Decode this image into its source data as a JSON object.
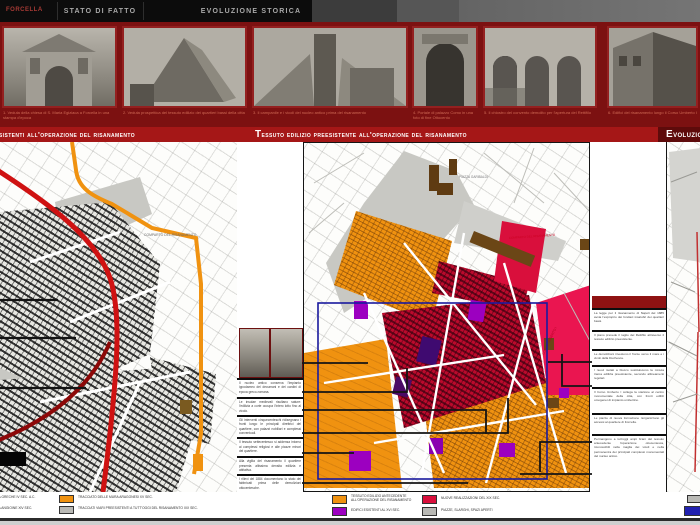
{
  "poster": {
    "region_label": "FORCELLA"
  },
  "tabs": [
    {
      "label": "STATO DI FATTO"
    },
    {
      "label": "EVOLUZIONE STORICA"
    }
  ],
  "titles": {
    "left": "Tracciati preesistenti all'operazione del risanamento",
    "center": "Tessuto edilizio preesistente all'operazione del risanamento",
    "right": "Evoluzione storica"
  },
  "photo_strip": {
    "photos": [
      {
        "caption": "1. Veduta della chiesa di S. Maria Egiziaca a Forcella in una stampa d'epoca"
      },
      {
        "caption": "2. Veduta prospettica del tessuto edilizio dei quartieri bassi della citta"
      },
      {
        "caption": "3. Il campanile e i vicoli del nucleo antico prima del risanamento"
      },
      {
        "caption": "4. Portale di palazzo Como in una foto di fine Ottocento"
      },
      {
        "caption": "5. Il chiostro del convento demolito per l'apertura del Rettifilo"
      },
      {
        "caption": "6. Edifici del risanamento lungo il Corso Umberto I"
      }
    ]
  },
  "left_map": {
    "label_comparto": "COMPARTO DEL RISANAMENTO"
  },
  "center_map": {
    "label_piazza": "PIAZZA GARIBALDI",
    "label_comparto": "COMPARTO DEL RISANAMENTO",
    "label_corso": "CORSO UMBERTO I"
  },
  "mid_notes": [
    "Il nucleo antico conserva l'impianto ippodameo dei decumani e dei cardini di epoca greco-romana.",
    "Le insulae medievali risultano sature: l'edilizia a corte occupa l'intero lotto fino al vicolo.",
    "Gli interventi cinquecenteschi ridisegnano i fronti lungo le principali direttrici del quartiere, con palazzi nobiliari e complessi conventuali.",
    "Il tessuto settecentesco si addensa intorno ai complessi religiosi e alle piazze minori del quartiere.",
    "Alla vigilia del risanamento il quartiere presenta altissima densita edilizia e abitativa.",
    "I rilievi del 1884 documentano lo stato dei fabbricati prima delle demolizioni ottocentesche."
  ],
  "right_notes": [
    "La legge per il risanamento di Napoli del 1885 avvia l'esproprio dei fondaci insalubri dei quartieri bassi.",
    "Il piano prevede il taglio del Rettifilo attraverso il tessuto edilizio preesistente.",
    "Le demolizioni investono il fronte verso il mare e i vicoli della Duchesca.",
    "I nuovi isolati a blocco sostituiscono la minuta trama edilizia preesistente, secondo allineamenti regolari.",
    "Il Corso Umberto I collega la stazione al centro monumentale della citta, con fronti edilizi omogenei di impianto umbertino.",
    "Le piazze di nuova formazione riorganizzano gli accessi al quartiere di Forcella.",
    "Permangono a tutt'oggi ampi brani del tessuto antecedente l'operazione ottocentesca, riconoscibili nella maglia dei vicoli e nella permanenza dei principali complessi monumentali del nucleo antico."
  ],
  "legend_left": {
    "rows": [
      {
        "edge_label": "TRACCIATO DELLE MURA GRECHE IV SEC. A.C.",
        "swatch_color": "#f09210",
        "swatch_label": "TRACCIATO DELLE MURA ARAGONESI XV SEC."
      },
      {
        "edge_label": "TRACCIATO DELLE MURA ANGIOINE XIV SEC.",
        "swatch_color": "#b9b9b5",
        "swatch_label": "TRACCIATI VIARI PREESISTENTI A TUTT'OGGI DEL RISANAMENTO XIX SEC."
      }
    ]
  },
  "legend_center": {
    "items": [
      {
        "color": "#f09210",
        "label": "TESSUTO EDILIZIO ANTECEDENTE ALL'OPERAZIONE DEL RISANAMENTO"
      },
      {
        "color": "#9c00c0",
        "label": "EDIFICI ESISTENTI AL XVI SEC."
      },
      {
        "color": "#d90f3c",
        "label": "NUOVE REALIZZAZIONI DEL XIX SEC."
      },
      {
        "color": "#b9b9b5",
        "label": "PIAZZE, SLARGHI, SPAZI APERTI"
      }
    ]
  },
  "legend_right": {
    "items": [
      {
        "color": "#b9b9b5",
        "label": ""
      },
      {
        "color": "#2121b0",
        "label": ""
      }
    ]
  },
  "colors": {
    "header_black": "#0c0c0c",
    "strip_red": "#7c1111",
    "title_red": "#a51717",
    "title_dark_red": "#5e0b0b",
    "route_red": "#cf1212",
    "route_orange": "#f09210",
    "fabric_crimson": "#bb0a2c",
    "pink_band": "#ea1550",
    "magenta": "#9c00c0",
    "study_blue": "#1a1a9e",
    "brown": "#6b4616"
  }
}
